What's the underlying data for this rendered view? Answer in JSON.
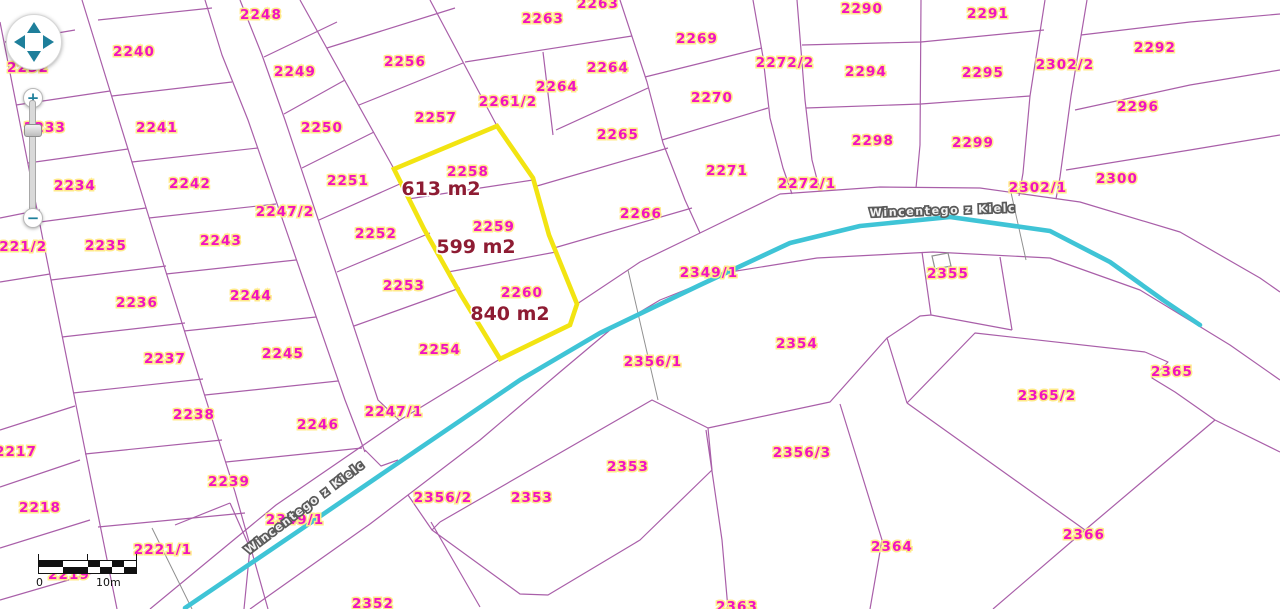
{
  "map": {
    "street_name": "Wincentego z Kielc",
    "colors": {
      "parcel_line": "#a95fa9",
      "parcel_label": "#f013c0",
      "halo": "#ffe98a",
      "area_label": "#8e1c33",
      "road": "#3fc4d6",
      "highlight": "#f2e412",
      "street_text": "#f2f2f2",
      "street_outline": "#5a5a5a",
      "control_teal": "#1e7f9b",
      "gray_line": "#909090"
    },
    "highlight_parcels": [
      {
        "id": "2258",
        "area": "613 m2",
        "lx": 468,
        "ly": 176,
        "ax": 441,
        "ay": 195
      },
      {
        "id": "2259",
        "area": "599 m2",
        "lx": 494,
        "ly": 231,
        "ax": 476,
        "ay": 253
      },
      {
        "id": "2260",
        "area": "840 m2",
        "lx": 522,
        "ly": 297,
        "ax": 510,
        "ay": 320
      }
    ],
    "parcel_labels": [
      {
        "id": "2232",
        "x": 28,
        "y": 72
      },
      {
        "id": "2233",
        "x": 45,
        "y": 132
      },
      {
        "id": "2234",
        "x": 75,
        "y": 190
      },
      {
        "id": "2221/2",
        "x": 18,
        "y": 251
      },
      {
        "id": "2235",
        "x": 106,
        "y": 250
      },
      {
        "id": "2236",
        "x": 137,
        "y": 307
      },
      {
        "id": "2237",
        "x": 165,
        "y": 363
      },
      {
        "id": "2238",
        "x": 194,
        "y": 419
      },
      {
        "id": "2239",
        "x": 229,
        "y": 486
      },
      {
        "id": "2217",
        "x": 16,
        "y": 456
      },
      {
        "id": "2218",
        "x": 40,
        "y": 512
      },
      {
        "id": "2219",
        "x": 69,
        "y": 579
      },
      {
        "id": "2221/1",
        "x": 163,
        "y": 554
      },
      {
        "id": "2240",
        "x": 134,
        "y": 56
      },
      {
        "id": "2241",
        "x": 157,
        "y": 132
      },
      {
        "id": "2242",
        "x": 190,
        "y": 188
      },
      {
        "id": "2243",
        "x": 221,
        "y": 245
      },
      {
        "id": "2244",
        "x": 251,
        "y": 300
      },
      {
        "id": "2245",
        "x": 283,
        "y": 358
      },
      {
        "id": "2246",
        "x": 318,
        "y": 429
      },
      {
        "id": "2247/2",
        "x": 285,
        "y": 216
      },
      {
        "id": "2247/1",
        "x": 394,
        "y": 416
      },
      {
        "id": "2248",
        "x": 261,
        "y": 19
      },
      {
        "id": "2249",
        "x": 295,
        "y": 76
      },
      {
        "id": "2250",
        "x": 322,
        "y": 132
      },
      {
        "id": "2251",
        "x": 348,
        "y": 185
      },
      {
        "id": "2252",
        "x": 376,
        "y": 238
      },
      {
        "id": "2253",
        "x": 404,
        "y": 290
      },
      {
        "id": "2254",
        "x": 440,
        "y": 354
      },
      {
        "id": "2256",
        "x": 405,
        "y": 66
      },
      {
        "id": "2257",
        "x": 436,
        "y": 122
      },
      {
        "id": "2261/2",
        "x": 508,
        "y": 106
      },
      {
        "id": "2263",
        "x": 543,
        "y": 23
      },
      {
        "id": "2263",
        "x": 598,
        "y": 8
      },
      {
        "id": "2264",
        "x": 608,
        "y": 72
      },
      {
        "id": "2264",
        "x": 557,
        "y": 91
      },
      {
        "id": "2265",
        "x": 618,
        "y": 139
      },
      {
        "id": "2266",
        "x": 641,
        "y": 218
      },
      {
        "id": "2269",
        "x": 697,
        "y": 43
      },
      {
        "id": "2270",
        "x": 712,
        "y": 102
      },
      {
        "id": "2271",
        "x": 727,
        "y": 175
      },
      {
        "id": "2272/2",
        "x": 785,
        "y": 67
      },
      {
        "id": "2272/1",
        "x": 807,
        "y": 188
      },
      {
        "id": "2290",
        "x": 862,
        "y": 13
      },
      {
        "id": "2291",
        "x": 988,
        "y": 18
      },
      {
        "id": "2292",
        "x": 1155,
        "y": 52
      },
      {
        "id": "2294",
        "x": 866,
        "y": 76
      },
      {
        "id": "2295",
        "x": 983,
        "y": 77
      },
      {
        "id": "2296",
        "x": 1138,
        "y": 111
      },
      {
        "id": "2298",
        "x": 873,
        "y": 145
      },
      {
        "id": "2299",
        "x": 973,
        "y": 147
      },
      {
        "id": "2300",
        "x": 1117,
        "y": 183
      },
      {
        "id": "2302/2",
        "x": 1065,
        "y": 69
      },
      {
        "id": "2302/1",
        "x": 1038,
        "y": 192
      },
      {
        "id": "2349/1",
        "x": 709,
        "y": 277
      },
      {
        "id": "2349/1",
        "x": 295,
        "y": 524
      },
      {
        "id": "2355",
        "x": 948,
        "y": 278
      },
      {
        "id": "2354",
        "x": 797,
        "y": 348
      },
      {
        "id": "2356/1",
        "x": 653,
        "y": 366
      },
      {
        "id": "2356/2",
        "x": 443,
        "y": 502
      },
      {
        "id": "2356/3",
        "x": 802,
        "y": 457
      },
      {
        "id": "2353",
        "x": 628,
        "y": 471
      },
      {
        "id": "2353",
        "x": 532,
        "y": 502
      },
      {
        "id": "2352",
        "x": 373,
        "y": 608
      },
      {
        "id": "2363",
        "x": 737,
        "y": 611
      },
      {
        "id": "2364",
        "x": 892,
        "y": 551
      },
      {
        "id": "2365/2",
        "x": 1047,
        "y": 400
      },
      {
        "id": "2365",
        "x": 1172,
        "y": 376
      },
      {
        "id": "2366",
        "x": 1084,
        "y": 539
      }
    ],
    "street_labels": [
      {
        "x": 943,
        "y": 214,
        "angle": -2
      },
      {
        "x": 307,
        "y": 510,
        "angle": -37
      }
    ]
  },
  "controls": {
    "zoom_in_label": "+",
    "zoom_out_label": "−",
    "pan_directions": [
      "up",
      "right",
      "down",
      "left"
    ],
    "scale_bar": {
      "start_label": "0",
      "end_label": "10m"
    }
  }
}
